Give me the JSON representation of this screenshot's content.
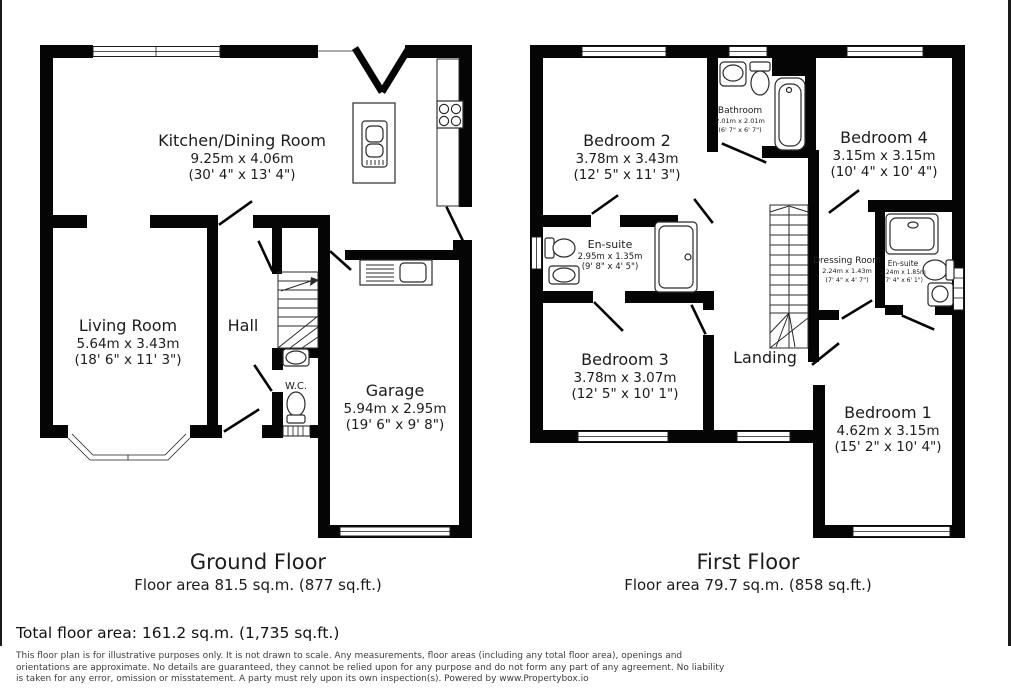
{
  "ground_floor": {
    "title": "Ground Floor",
    "area_line": "Floor area 81.5 sq.m. (877 sq.ft.)",
    "rooms": {
      "kitchen_dining": {
        "name": "Kitchen/Dining Room",
        "size_m": "9.25m x 4.06m",
        "size_ft": "(30' 4\" x 13' 4\")"
      },
      "living_room": {
        "name": "Living Room",
        "size_m": "5.64m x 3.43m",
        "size_ft": "(18' 6\" x 11' 3\")"
      },
      "hall": {
        "name": "Hall"
      },
      "wc": {
        "name": "W.C."
      },
      "garage": {
        "name": "Garage",
        "size_m": "5.94m x 2.95m",
        "size_ft": "(19' 6\" x 9' 8\")"
      }
    }
  },
  "first_floor": {
    "title": "First Floor",
    "area_line": "Floor area 79.7 sq.m. (858 sq.ft.)",
    "rooms": {
      "bedroom_2": {
        "name": "Bedroom 2",
        "size_m": "3.78m x 3.43m",
        "size_ft": "(12' 5\" x 11' 3\")"
      },
      "bathroom": {
        "name": "Bathroom",
        "size_m": "2.01m x 2.01m",
        "size_ft": "(6' 7\" x 6' 7\")"
      },
      "bedroom_4": {
        "name": "Bedroom 4",
        "size_m": "3.15m x 3.15m",
        "size_ft": "(10' 4\" x 10' 4\")"
      },
      "ensuite_2": {
        "name": "En-suite",
        "size_m": "2.95m x 1.35m",
        "size_ft": "(9' 8\" x 4' 5\")"
      },
      "dressing_room": {
        "name": "Dressing Room",
        "size_m": "2.24m x 1.43m",
        "size_ft": "(7' 4\" x 4' 7\")"
      },
      "ensuite_1": {
        "name": "En-suite",
        "size_m": "2.24m x 1.85m",
        "size_ft": "(7' 4\" x 6' 1\")"
      },
      "bedroom_3": {
        "name": "Bedroom 3",
        "size_m": "3.78m x 3.07m",
        "size_ft": "(12' 5\" x 10' 1\")"
      },
      "landing": {
        "name": "Landing"
      },
      "bedroom_1": {
        "name": "Bedroom 1",
        "size_m": "4.62m x 3.15m",
        "size_ft": "(15' 2\" x 10' 4\")"
      }
    }
  },
  "footer": {
    "total_area": "Total floor area: 161.2 sq.m. (1,735 sq.ft.)",
    "disclaimer": "This floor plan is for illustrative purposes only. It is not drawn to scale. Any measurements, floor areas (including any total floor area), openings and orientations are approximate. No details are guaranteed, they cannot be relied upon for any purpose and do not form any part of any agreement. No liability is taken for any error, omission or misstatement. A party must rely upon its own inspection(s). Powered by www.Propertybox.io"
  },
  "colors": {
    "wall": "#050505",
    "background": "#ffffff",
    "text": "#1c1c1c"
  }
}
